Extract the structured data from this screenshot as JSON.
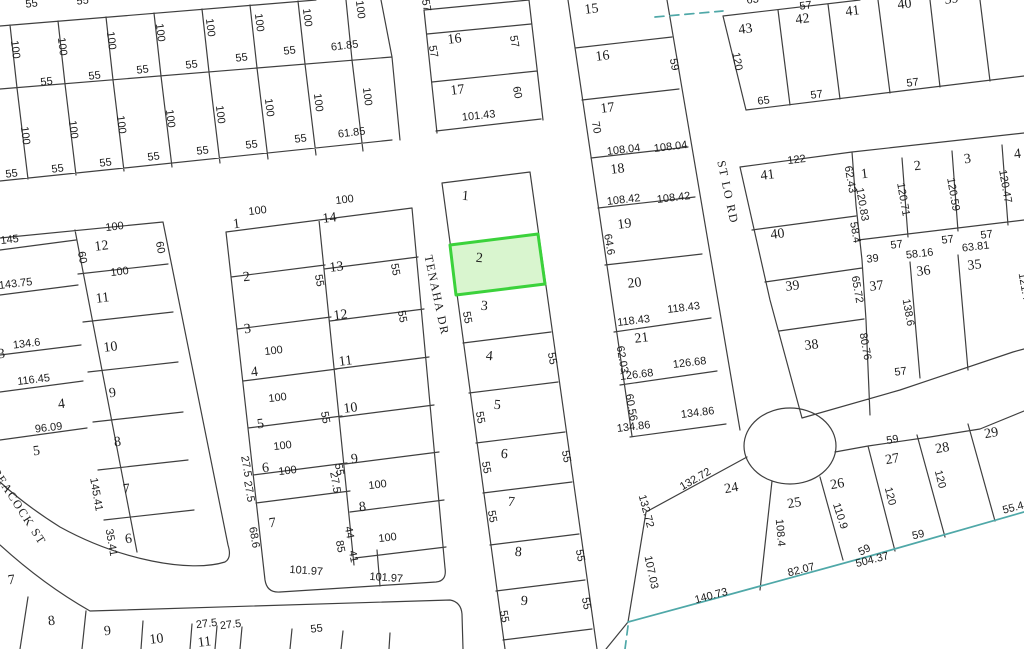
{
  "map": {
    "colors": {
      "background": "#ffffff",
      "line": "#3f3f3f",
      "boundary": "#4fa8a8",
      "highlight_fill": "#d9f5cf",
      "highlight_stroke": "#3bd23b",
      "text": "#1c1c1c"
    },
    "highlighted_lot": {
      "number": "2"
    },
    "streets": [
      [
        "TENAHA DR",
        433,
        296,
        78
      ],
      [
        "ST LO RD",
        724,
        193,
        78
      ],
      [
        "PEACOCK ST",
        16,
        509,
        57
      ]
    ],
    "lot_labels": [
      [
        "16",
        455,
        43,
        -7
      ],
      [
        "17",
        458,
        94,
        -7
      ],
      [
        "1",
        465,
        200,
        5
      ],
      [
        "2",
        479,
        262,
        5
      ],
      [
        "3",
        484,
        310,
        5
      ],
      [
        "4",
        489,
        360,
        5
      ],
      [
        "5",
        497,
        409,
        5
      ],
      [
        "6",
        504,
        458,
        5
      ],
      [
        "7",
        511,
        506,
        5
      ],
      [
        "8",
        518,
        556,
        5
      ],
      [
        "9",
        524,
        605,
        5
      ],
      [
        "1",
        237,
        228,
        -7
      ],
      [
        "14",
        330,
        222,
        -7
      ],
      [
        "2",
        247,
        281,
        -7
      ],
      [
        "13",
        337,
        271,
        -7
      ],
      [
        "3",
        248,
        333,
        -7
      ],
      [
        "12",
        341,
        319,
        -7
      ],
      [
        "4",
        255,
        376,
        -7
      ],
      [
        "11",
        346,
        365,
        -7
      ],
      [
        "5",
        261,
        428,
        -7
      ],
      [
        "10",
        351,
        412,
        -7
      ],
      [
        "6",
        266,
        472,
        -7
      ],
      [
        "9",
        355,
        463,
        -7
      ],
      [
        "7",
        273,
        527,
        -7
      ],
      [
        "8",
        363,
        511,
        -7
      ],
      [
        "12",
        102,
        250,
        -7
      ],
      [
        "11",
        103,
        302,
        -7
      ],
      [
        "10",
        111,
        351,
        -7
      ],
      [
        "3",
        2,
        358,
        -7
      ],
      [
        "9",
        113,
        397,
        -7
      ],
      [
        "4",
        62,
        408,
        -7
      ],
      [
        "8",
        118,
        446,
        -7
      ],
      [
        "5",
        37,
        455,
        -7
      ],
      [
        "7",
        127,
        493,
        -7
      ],
      [
        "6",
        129,
        543,
        -7
      ],
      [
        "7",
        12,
        584,
        -7
      ],
      [
        "8",
        52,
        625,
        -7
      ],
      [
        "9",
        108,
        635,
        -7
      ],
      [
        "10",
        157,
        643,
        -7
      ],
      [
        "11",
        205,
        646,
        -7
      ],
      [
        "15",
        592,
        13,
        -7
      ],
      [
        "16",
        603,
        60,
        -7
      ],
      [
        "17",
        608,
        112,
        -7
      ],
      [
        "18",
        618,
        173,
        -7
      ],
      [
        "19",
        625,
        228,
        -7
      ],
      [
        "20",
        635,
        287,
        -7
      ],
      [
        "21",
        642,
        342,
        -7
      ],
      [
        "43",
        746,
        33,
        -7
      ],
      [
        "42",
        803,
        23,
        -7
      ],
      [
        "41",
        853,
        15,
        -7
      ],
      [
        "40",
        905,
        8,
        -7
      ],
      [
        "39",
        952,
        3,
        -7
      ],
      [
        "41",
        768,
        179,
        -7
      ],
      [
        "40",
        778,
        238,
        -7
      ],
      [
        "39",
        793,
        290,
        -7
      ],
      [
        "38",
        812,
        349,
        -7
      ],
      [
        "1",
        865,
        178,
        -7
      ],
      [
        "2",
        918,
        170,
        -7
      ],
      [
        "3",
        968,
        163,
        -7
      ],
      [
        "4",
        1018,
        158,
        -7
      ],
      [
        "37",
        877,
        290,
        -7
      ],
      [
        "36",
        924,
        275,
        -7
      ],
      [
        "35",
        975,
        269,
        -7
      ],
      [
        "24",
        732,
        492,
        -10
      ],
      [
        "25",
        795,
        507,
        -10
      ],
      [
        "26",
        838,
        488,
        -10
      ],
      [
        "27",
        893,
        463,
        -10
      ],
      [
        "28",
        943,
        452,
        -10
      ],
      [
        "29",
        992,
        437,
        -10
      ]
    ],
    "dim_labels": [
      [
        "55",
        32,
        7,
        -7
      ],
      [
        "55",
        83,
        4,
        -7
      ],
      [
        "100",
        12,
        50,
        83
      ],
      [
        "100",
        59,
        47,
        83
      ],
      [
        "100",
        108,
        41,
        83
      ],
      [
        "100",
        157,
        33,
        83
      ],
      [
        "100",
        207,
        28,
        83
      ],
      [
        "100",
        256,
        23,
        83
      ],
      [
        "100",
        304,
        18,
        83
      ],
      [
        "100",
        357,
        10,
        83
      ],
      [
        "55",
        47,
        85,
        -7
      ],
      [
        "55",
        95,
        79,
        -7
      ],
      [
        "55",
        143,
        73,
        -7
      ],
      [
        "55",
        192,
        68,
        -7
      ],
      [
        "55",
        242,
        61,
        -7
      ],
      [
        "55",
        290,
        54,
        -7
      ],
      [
        "61.85",
        345,
        49,
        -7
      ],
      [
        "100",
        22,
        136,
        83
      ],
      [
        "100",
        70,
        130,
        83
      ],
      [
        "100",
        118,
        125,
        83
      ],
      [
        "100",
        167,
        119,
        83
      ],
      [
        "100",
        217,
        115,
        83
      ],
      [
        "100",
        266,
        108,
        83
      ],
      [
        "100",
        315,
        103,
        83
      ],
      [
        "100",
        364,
        97,
        83
      ],
      [
        "55",
        12,
        177,
        -7
      ],
      [
        "55",
        58,
        172,
        -7
      ],
      [
        "55",
        106,
        166,
        -7
      ],
      [
        "55",
        154,
        160,
        -7
      ],
      [
        "55",
        203,
        154,
        -7
      ],
      [
        "55",
        252,
        148,
        -7
      ],
      [
        "55",
        301,
        142,
        -7
      ],
      [
        "61.85",
        352,
        136,
        -7
      ],
      [
        "57",
        423,
        6,
        80
      ],
      [
        "57",
        430,
        52,
        80
      ],
      [
        "57",
        511,
        42,
        80
      ],
      [
        "60",
        514,
        93,
        80
      ],
      [
        "101.43",
        479,
        119,
        -6
      ],
      [
        "55",
        464,
        318,
        80
      ],
      [
        "55",
        549,
        359,
        80
      ],
      [
        "55",
        477,
        418,
        80
      ],
      [
        "55",
        483,
        468,
        80
      ],
      [
        "55",
        563,
        457,
        80
      ],
      [
        "55",
        489,
        517,
        80
      ],
      [
        "55",
        577,
        556,
        80
      ],
      [
        "55",
        501,
        617,
        80
      ],
      [
        "55",
        583,
        604,
        80
      ],
      [
        "100",
        258,
        214,
        -7
      ],
      [
        "100",
        345,
        203,
        -7
      ],
      [
        "55",
        316,
        281,
        80
      ],
      [
        "55",
        392,
        270,
        80
      ],
      [
        "55",
        399,
        317,
        80
      ],
      [
        "100",
        274,
        354,
        -7
      ],
      [
        "100",
        278,
        401,
        -7
      ],
      [
        "55",
        322,
        418,
        80
      ],
      [
        "100",
        283,
        449,
        -7
      ],
      [
        "100",
        288,
        474,
        -7
      ],
      [
        "55",
        336,
        470,
        80
      ],
      [
        "27.5",
        243,
        467,
        80
      ],
      [
        "27.5",
        246,
        492,
        80
      ],
      [
        "27.5",
        332,
        483,
        80
      ],
      [
        "100",
        378,
        488,
        -7
      ],
      [
        "68.6",
        251,
        538,
        80
      ],
      [
        "44",
        346,
        533,
        80
      ],
      [
        "85",
        337,
        547,
        80
      ],
      [
        "41",
        350,
        557,
        80
      ],
      [
        "100",
        388,
        541,
        -7
      ],
      [
        "101.97",
        306,
        574,
        4
      ],
      [
        "101.97",
        386,
        581,
        4
      ],
      [
        "145",
        10,
        243,
        -7
      ],
      [
        "100",
        115,
        230,
        -7
      ],
      [
        "60",
        79,
        258,
        80
      ],
      [
        "60",
        157,
        248,
        80
      ],
      [
        "100",
        120,
        275,
        -7
      ],
      [
        "143.75",
        16,
        287,
        -7
      ],
      [
        "134.6",
        27,
        347,
        -7
      ],
      [
        "116.45",
        34,
        383,
        -7
      ],
      [
        "96.09",
        49,
        431,
        -7
      ],
      [
        "145.41",
        93,
        495,
        80
      ],
      [
        "35.41",
        108,
        543,
        80
      ],
      [
        "27.5",
        207,
        627,
        -7
      ],
      [
        "27.5",
        231,
        628,
        -7
      ],
      [
        "55",
        317,
        632,
        -7
      ],
      [
        "59",
        671,
        65,
        80
      ],
      [
        "70",
        593,
        128,
        80
      ],
      [
        "108.04",
        624,
        153,
        -7
      ],
      [
        "108.04",
        671,
        150,
        -7
      ],
      [
        "108.42",
        624,
        203,
        -7
      ],
      [
        "108.42",
        674,
        201,
        -7
      ],
      [
        "64.6",
        606,
        245,
        80
      ],
      [
        "118.43",
        634,
        324,
        -7
      ],
      [
        "118.43",
        684,
        311,
        -7
      ],
      [
        "62.03",
        619,
        360,
        80
      ],
      [
        "126.68",
        637,
        378,
        -7
      ],
      [
        "126.68",
        690,
        366,
        -7
      ],
      [
        "60.56",
        628,
        408,
        80
      ],
      [
        "134.86",
        634,
        430,
        -7
      ],
      [
        "134.86",
        698,
        416,
        -7
      ],
      [
        "63",
        753,
        3,
        -7
      ],
      [
        "57",
        806,
        9,
        -7
      ],
      [
        "120",
        734,
        62,
        80
      ],
      [
        "65",
        764,
        104,
        -7
      ],
      [
        "57",
        817,
        98,
        -7
      ],
      [
        "57",
        913,
        86,
        -7
      ],
      [
        "122",
        797,
        163,
        -7
      ],
      [
        "62.43",
        847,
        180,
        80
      ],
      [
        "120.83",
        859,
        205,
        80
      ],
      [
        "120.71",
        900,
        200,
        80
      ],
      [
        "120.59",
        950,
        195,
        80
      ],
      [
        "120.47",
        1002,
        187,
        80
      ],
      [
        "58.4",
        852,
        233,
        80
      ],
      [
        "57",
        897,
        248,
        -7
      ],
      [
        "39",
        873,
        262,
        -7
      ],
      [
        "58.16",
        920,
        257,
        -7
      ],
      [
        "57",
        948,
        243,
        -7
      ],
      [
        "63.81",
        976,
        250,
        -7
      ],
      [
        "57",
        987,
        238,
        -7
      ],
      [
        "65.72",
        854,
        290,
        80
      ],
      [
        "80.76",
        862,
        347,
        80
      ],
      [
        "138.6",
        905,
        313,
        80
      ],
      [
        "57",
        901,
        375,
        -7
      ],
      [
        "121.4",
        1021,
        287,
        80
      ],
      [
        "132.72",
        697,
        482,
        -30
      ],
      [
        "132.72",
        643,
        512,
        75
      ],
      [
        "107.03",
        648,
        573,
        78
      ],
      [
        "140.73",
        712,
        599,
        -15
      ],
      [
        "108.4",
        777,
        533,
        85
      ],
      [
        "82.07",
        802,
        573,
        -14
      ],
      [
        "110.9",
        837,
        517,
        72
      ],
      [
        "59",
        866,
        553,
        -28
      ],
      [
        "504.37",
        873,
        563,
        -14
      ],
      [
        "120",
        887,
        497,
        76
      ],
      [
        "59",
        893,
        443,
        -10
      ],
      [
        "120",
        937,
        480,
        76
      ],
      [
        "59",
        919,
        538,
        -13
      ],
      [
        "55.4",
        1014,
        511,
        -15
      ]
    ]
  }
}
